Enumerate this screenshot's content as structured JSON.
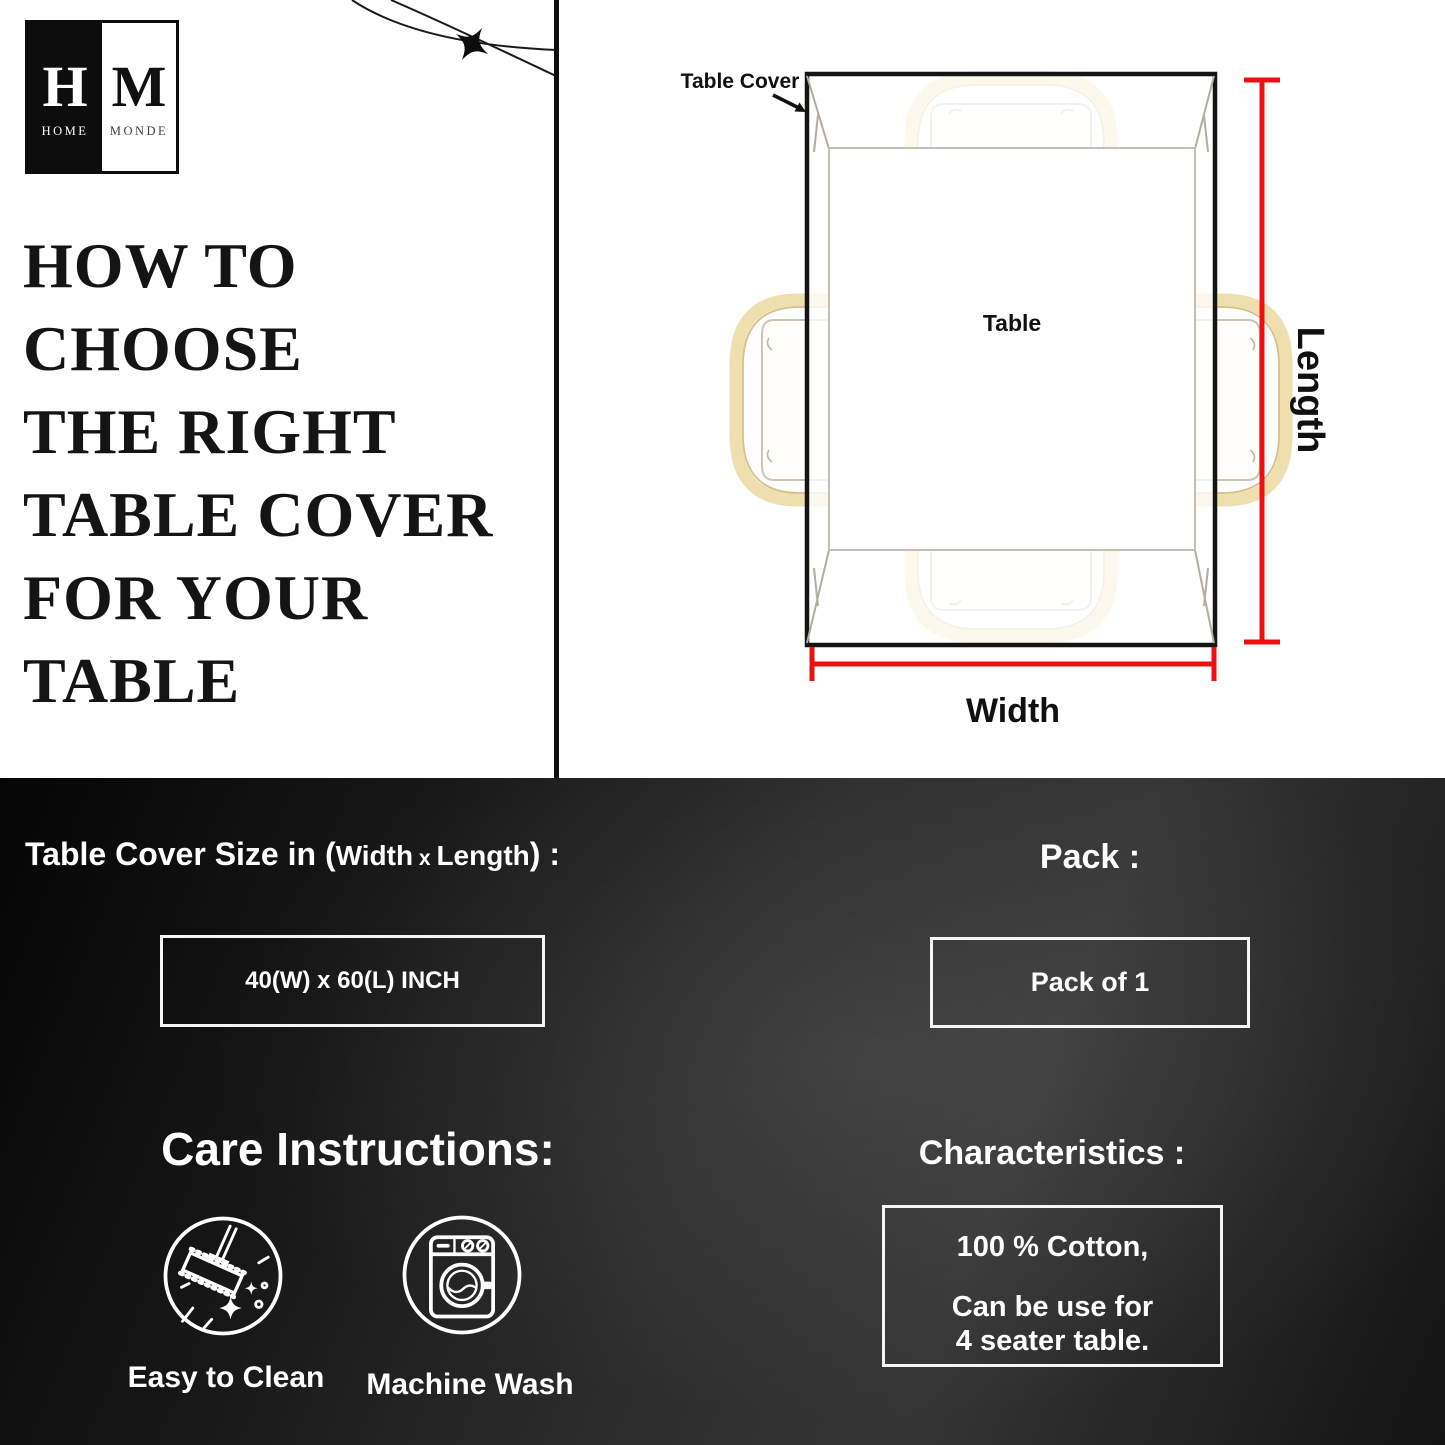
{
  "logo": {
    "h": "H",
    "m": "M",
    "home": "HOME",
    "monde": "MONDE"
  },
  "title": {
    "lines": [
      "HOW TO",
      "CHOOSE",
      "THE RIGHT",
      "TABLE COVER",
      "FOR YOUR",
      "TABLE"
    ]
  },
  "diagram": {
    "cover_label": "Table Cover",
    "table_label": "Table",
    "length_label": "Length",
    "width_label": "Width",
    "dimension_arrow_color": "#ee1010",
    "chair_color": "#efdfaf",
    "icons": [
      "table-top-view-icon",
      "chair-icon",
      "sparkle-star-icon"
    ]
  },
  "size_section": {
    "heading_p1": "Table Cover Size in (",
    "heading_p2": "Width",
    "heading_p3": " x ",
    "heading_p4": "Length",
    "heading_p5": ") :",
    "value": "40(W) x 60(L) INCH"
  },
  "pack_section": {
    "heading": "Pack :",
    "value": "Pack of 1"
  },
  "care_section": {
    "heading": "Care Instructions:",
    "items": [
      {
        "icon": "mop-icon",
        "label": "Easy to Clean"
      },
      {
        "icon": "washing-machine-icon",
        "label": "Machine Wash"
      }
    ]
  },
  "characteristics_section": {
    "heading": "Characteristics :",
    "line1": "100 % Cotton,",
    "line2": "Can be use for",
    "line3": "4 seater table."
  }
}
